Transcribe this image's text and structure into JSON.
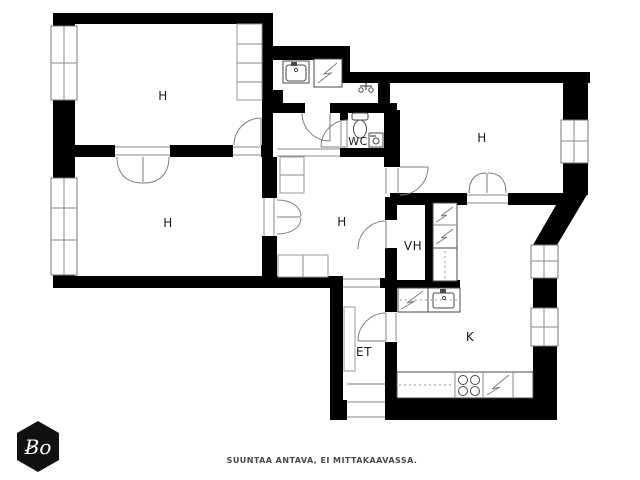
{
  "floorplan": {
    "rooms": [
      {
        "id": "room-top-left",
        "label": "H"
      },
      {
        "id": "room-bottom-left",
        "label": "H"
      },
      {
        "id": "room-middle",
        "label": "H"
      },
      {
        "id": "room-right",
        "label": "H"
      },
      {
        "id": "wc",
        "label": "WC"
      },
      {
        "id": "closet-vh",
        "label": "VH"
      },
      {
        "id": "entry-et",
        "label": "ET"
      },
      {
        "id": "kitchen-k",
        "label": "K"
      }
    ],
    "fixture_icons": [
      "bathroom-sink-icon",
      "washing-machine-icon",
      "shower-tap-icon",
      "toilet-icon",
      "wc-basin-icon",
      "fridge-freezer-icon",
      "dishwasher-icon",
      "kitchen-sink-icon",
      "stove-icon",
      "wardrobe-icon",
      "window-icon",
      "door-arc-icon"
    ],
    "footer_note": "SUUNTAA ANTAVA, EI MITTAKAAVASSA.",
    "logo_text": "Bo",
    "colors": {
      "wall": "#000000",
      "background": "#ffffff",
      "fixture_line": "#4a4a4a",
      "label_text": "#1a1a1a",
      "footer_text": "#4a4a4a",
      "logo_bg": "#111111",
      "logo_text": "#ffffff"
    }
  }
}
